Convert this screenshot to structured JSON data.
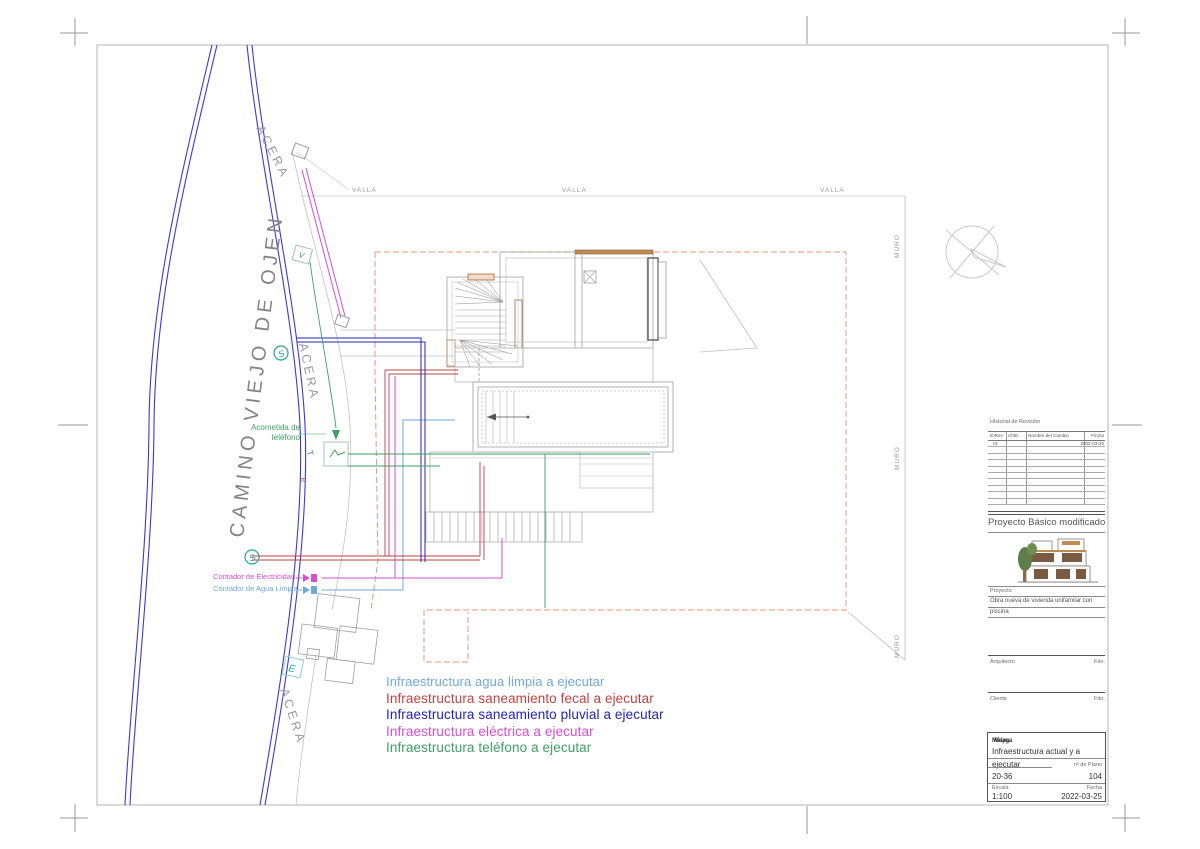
{
  "colors": {
    "road": "#3a3ad0",
    "teal": "#2ba395",
    "boundary": "#e89478",
    "cad_gray": "#a8a8a8",
    "brown": "#a86a3a"
  },
  "plan": {
    "street_name": "CAMINO VIEJO DE OJEN",
    "sidewalk_label": "ACERA",
    "fence_label": "VALLA",
    "wall_label": "MURO",
    "marker_s": "S",
    "marker_v": "V",
    "marker_t": "T",
    "marker_e_small": "e",
    "marker_e": "E",
    "acometida_line1": "Acometida de",
    "acometida_line2": "teléfono",
    "contador_electricidad": "Contador de Electricidad",
    "contador_agua": "Contador de Agua Limpia"
  },
  "legend": {
    "items": [
      {
        "label": "Infraestructura agua limpia a ejecutar",
        "color": "#6fa8dc"
      },
      {
        "label": "Infraestructura saneamiento fecal a ejecutar",
        "color": "#bf4242"
      },
      {
        "label": "Infraestructura saneamiento pluvial a ejecutar",
        "color": "#2424b4"
      },
      {
        "label": "Infraestructura eléctrica a ejecutar",
        "color": "#d24fd2"
      },
      {
        "label": "Infraestructura teléfono a ejecutar",
        "color": "#3f9e63"
      }
    ]
  },
  "titleblock": {
    "revision": {
      "title": "Historial de Revisión",
      "col_idrev": "IDRev",
      "col_chid": "ChID",
      "col_nombre": "Nombre del Cambio",
      "col_fecha": "Fecha",
      "row_id": "01",
      "row_fecha": "2022-03-25"
    },
    "phase": "Proyecto Básico modificado",
    "proyecto_label": "Proyecto",
    "proyecto_line1": "Obra nueva de vivienda unifamilar con",
    "proyecto_line2": "piscina",
    "arquitecto_label": "Arquitecto",
    "cliente_label": "Cliente",
    "fdo_label": "Fdo.",
    "location_overlay_a": "Málaga",
    "location_overlay_b": "Mapa:",
    "sheet_title_line1": "Infraestructura actual y a",
    "sheet_title_line2": "ejecutar",
    "project_number": "20-36",
    "plano_num_label": "nº de Plano",
    "plano_num": "104",
    "escala_label": "Escala",
    "escala_value": "1:100",
    "fecha_label": "Fecha",
    "fecha_value": "2022-03-25"
  }
}
